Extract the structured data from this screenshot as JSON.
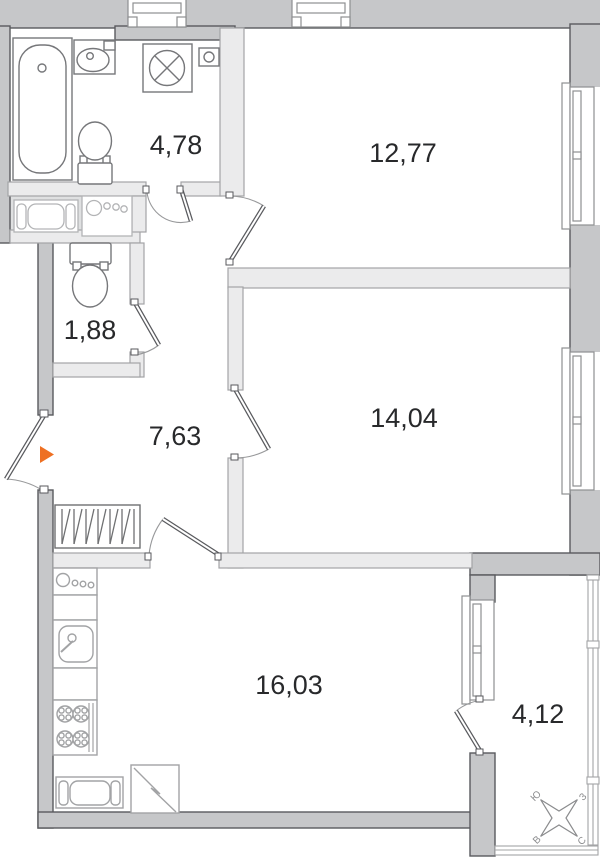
{
  "plan": {
    "title": "apartment-floor-plan",
    "rooms": {
      "bathroom": {
        "area": "4,78"
      },
      "living_room": {
        "area": "12,77"
      },
      "wc": {
        "area": "1,88"
      },
      "hallway": {
        "area": "7,63"
      },
      "bedroom": {
        "area": "14,04"
      },
      "kitchen": {
        "area": "16,03"
      },
      "balcony": {
        "area": "4,12"
      }
    },
    "compass": {
      "north": "С",
      "south": "Ю",
      "east": "В",
      "west": "З"
    },
    "entry_marker_color": "#ee7023",
    "fixtures": [
      "bathtub",
      "wash-basin",
      "washing-machine",
      "water-meter",
      "toilet",
      "toilet",
      "wardrobe",
      "kitchen-appliance",
      "kitchen-sink",
      "gas-stove",
      "radiator",
      "refrigerator",
      "neighbor-radiator",
      "neighbor-stove"
    ],
    "colors": {
      "exterior_wall": "#c6c7c9",
      "interior_wall": "#ebebec",
      "label": "#28292b"
    }
  }
}
